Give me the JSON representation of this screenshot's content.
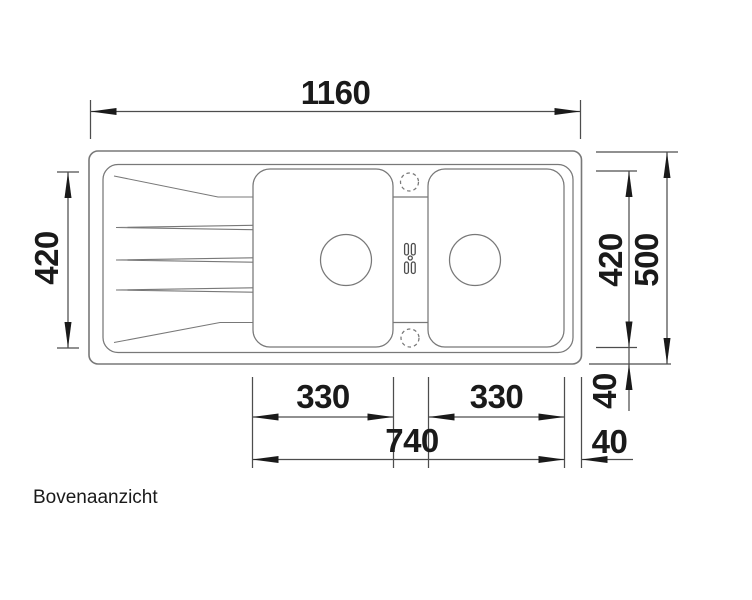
{
  "drawing": {
    "caption": "Bovenaanzicht",
    "dimensions": {
      "overall_width": "1160",
      "left_height": "420",
      "right_bowl_height": "420",
      "overall_depth": "500",
      "rim_bottom": "40",
      "rim_right": "40",
      "center_bowl_width": "330",
      "right_bowl_width": "330",
      "bowls_total_width": "740"
    },
    "colors": {
      "outline": "#787878",
      "dimension_line": "#4d4d4d",
      "text": "#1a1a1a",
      "background": "#ffffff"
    }
  }
}
